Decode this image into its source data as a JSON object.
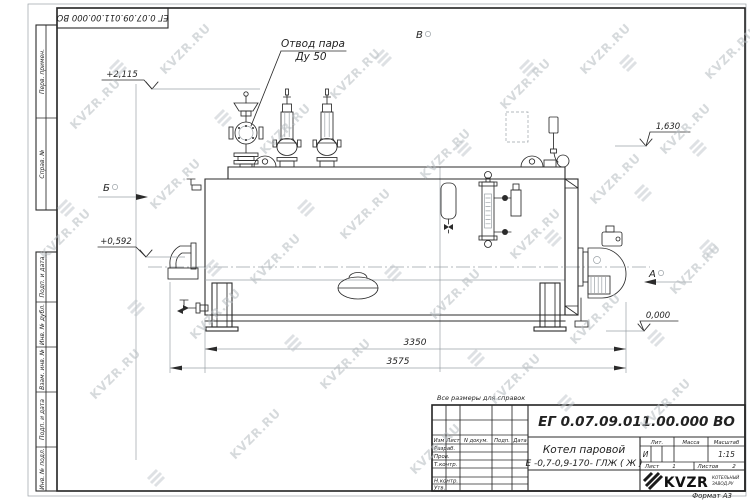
{
  "sheet": {
    "format_note": "Формат А3",
    "reference_note": "Все размеры для справок",
    "stamp_doc_number": "ЕГ 0.07.09.011.00.000  ВО"
  },
  "watermark": {
    "text": "KVZR.RU"
  },
  "frame_labels": {
    "perv_primen": "Перв. примен.",
    "sprav_no": "Справ. №",
    "podp_data_1": "Подп. и дата",
    "inv_dubl": "Инв. № дубл.",
    "vzam_inv": "Взам. инв. №",
    "podp_data_2": "Подп. и дата",
    "inv_podl": "Инв. № подл."
  },
  "drawing": {
    "callout": {
      "line1": "Отвод пара",
      "line2": "Ду 50"
    },
    "views": {
      "top": "В",
      "left": "Б",
      "right": "А"
    },
    "elevations": {
      "valve_top": "+2,115",
      "drum_top": "1,630",
      "left_mid": "+0,592",
      "ground": "0,000"
    },
    "dimensions": {
      "body_length": "3350",
      "overall_length": "3575"
    }
  },
  "title_block": {
    "doc_number": "ЕГ 0.07.09.011.00.000  ВО",
    "product_line1": "Котел паровой",
    "product_line2": "Е -0,7-0,9-170- ГЛЖ ( Ж )",
    "columns": {
      "izm": "Изм",
      "list": "Лист",
      "doc": "N докум.",
      "podp": "Подп.",
      "data": "Дата"
    },
    "rows": {
      "razrab": "Разраб.",
      "prov": "Пров.",
      "tkontr": "Т.контр.",
      "nkontr": "Н.контр.",
      "utv": "Утв."
    },
    "lit": {
      "header": "Лит.",
      "value": "И"
    },
    "mass": {
      "header": "Масса"
    },
    "scale": {
      "header": "Масштаб",
      "value": "1:15"
    },
    "sheet_no": {
      "label": "Лист",
      "value": "1"
    },
    "sheets_total": {
      "label": "Листов",
      "value": "2"
    },
    "company": {
      "name": "KVZR",
      "sub1": "КОТЕЛЬНЫЙ",
      "sub2": "ЗАВОД.РУ"
    }
  }
}
